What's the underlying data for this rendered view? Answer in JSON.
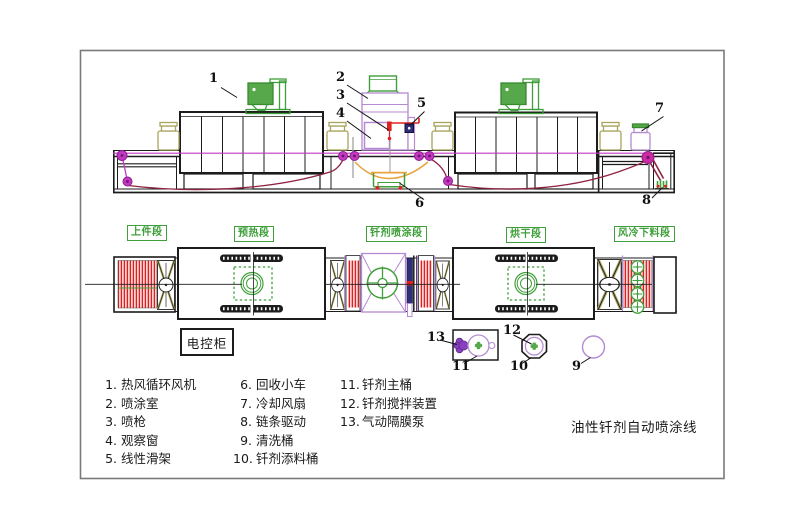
{
  "title": "油性钎剂自动喷涂线",
  "control_cabinet_label": "电控柜",
  "sections": {
    "s1": "上件段",
    "s2": "预热段",
    "s3": "钎剂喷涂段",
    "s4": "烘干段",
    "s5": "风冷下料段"
  },
  "callouts": {
    "c1": "1",
    "c2": "2",
    "c3": "3",
    "c4": "4",
    "c5": "5",
    "c6": "6",
    "c7": "7",
    "c8": "8",
    "c9": "9",
    "c10": "10",
    "c11": "11",
    "c12": "12",
    "c13": "13"
  },
  "legend": {
    "items": [
      {
        "no": "1.",
        "label": "热风循环风机"
      },
      {
        "no": "2.",
        "label": "喷涂室"
      },
      {
        "no": "3.",
        "label": "喷枪"
      },
      {
        "no": "4.",
        "label": "观察窗"
      },
      {
        "no": "5.",
        "label": "线性滑架"
      },
      {
        "no": "6.",
        "label": "回收小车"
      },
      {
        "no": "7.",
        "label": "冷却风扇"
      },
      {
        "no": "8.",
        "label": "链条驱动"
      },
      {
        "no": "9.",
        "label": "清洗桶"
      },
      {
        "no": "10.",
        "label": "钎剂添料桶"
      },
      {
        "no": "11.",
        "label": "钎剂主桶"
      },
      {
        "no": "12.",
        "label": "钎剂搅拌装置"
      },
      {
        "no": "13.",
        "label": "气动隔膜泵"
      }
    ]
  },
  "colors": {
    "cad_green": "#3f9f3a",
    "cad_red": "#e02020",
    "magenta": "#c238c2",
    "violet": "#b48ad2",
    "maroon_chain": "#8e2240",
    "orange": "#e8a33d",
    "navy": "#2e2e7a",
    "khaki": "#a9a35e",
    "line_black": "#1c1c1c",
    "frame_gray": "#7a7a7a"
  }
}
